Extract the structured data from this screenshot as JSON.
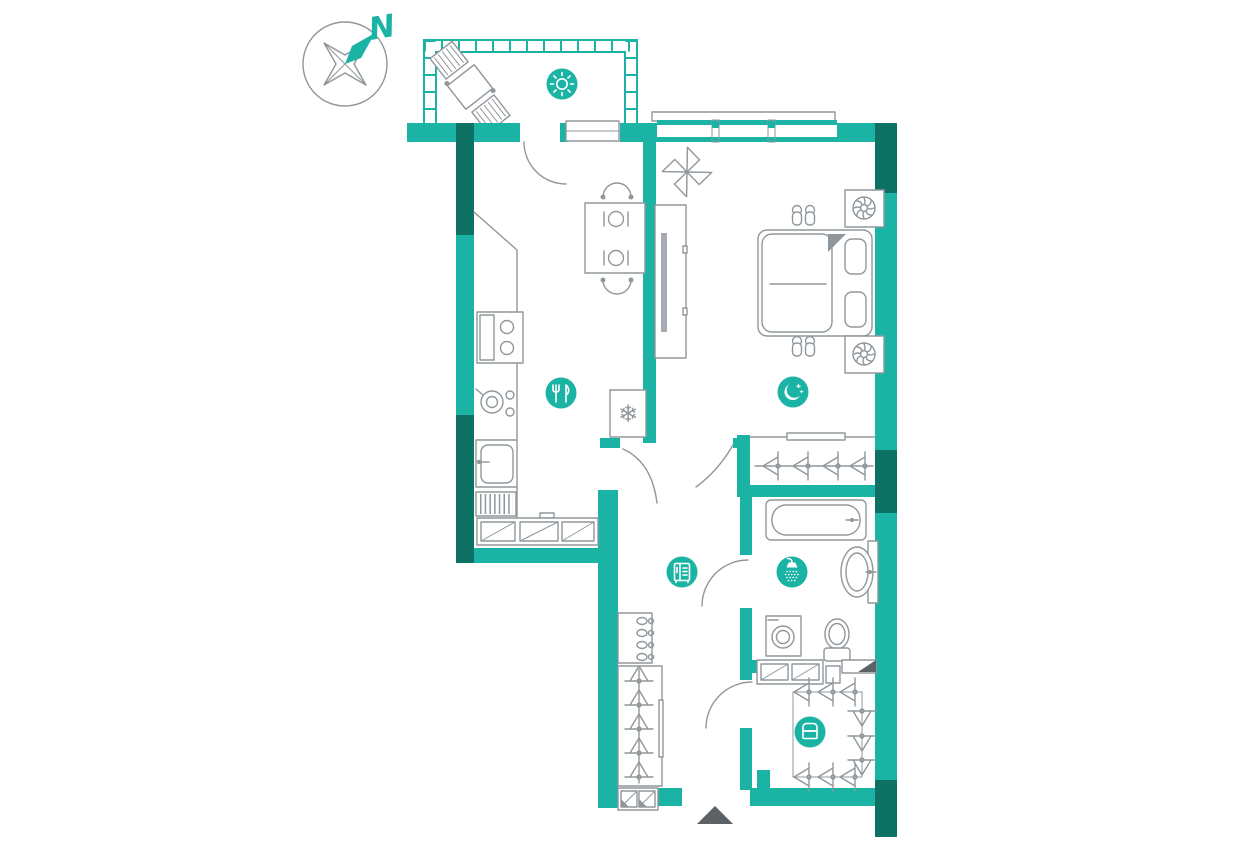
{
  "page": {
    "type": "apartment-floor-plan",
    "background": "#ffffff"
  },
  "colors": {
    "wall_teal": "#1bb3a4",
    "wall_dark_teal": "#0d7164",
    "furniture_gray": "#90979c",
    "entrance_arrow_gray": "#5d6266",
    "badge_teal": "#1bb3a4",
    "badge_icon_white": "#ffffff"
  },
  "compass": {
    "label": "N",
    "pointer_direction": "north-east"
  },
  "rooms": [
    {
      "name": "balcony",
      "badge_icon": "sun-icon"
    },
    {
      "name": "kitchen-dining",
      "badge_icon": "fork-knife-icon"
    },
    {
      "name": "bedroom",
      "badge_icon": "moon-stars-icon"
    },
    {
      "name": "hallway",
      "badge_icon": "wardrobe-icon"
    },
    {
      "name": "bathroom",
      "badge_icon": "shower-icon"
    },
    {
      "name": "walk-in-closet",
      "badge_icon": "chest-icon"
    }
  ],
  "fixtures": {
    "balcony": [
      "outdoor-table-and-two-chairs",
      "segmented-railing"
    ],
    "kitchen": [
      "corner-counter",
      "stove-with-oven",
      "pot",
      "sink",
      "dish-rack",
      "bench-seat",
      "dining-table-for-two",
      "fridge-freezer-with-snowflake"
    ],
    "bedroom": [
      "sliding-wardrobe",
      "double-bed",
      "two-pillows",
      "two-pairs-of-slippers",
      "two-ventilation-units",
      "ceiling-fan-sketch",
      "window"
    ],
    "closet": [
      "hanger-rod-with-hangers",
      "top-shelf"
    ],
    "bathroom": [
      "bathtub",
      "washbasin",
      "washing-machine",
      "toilet",
      "vanity-shelves"
    ],
    "hallway": [
      "shoe-cabinet",
      "tall-wardrobe-with-hangers",
      "shoe-bench",
      "entrance-arrow"
    ],
    "walk_in_closet": [
      "u-shaped-hanger-rods",
      "storage-shelf"
    ]
  }
}
